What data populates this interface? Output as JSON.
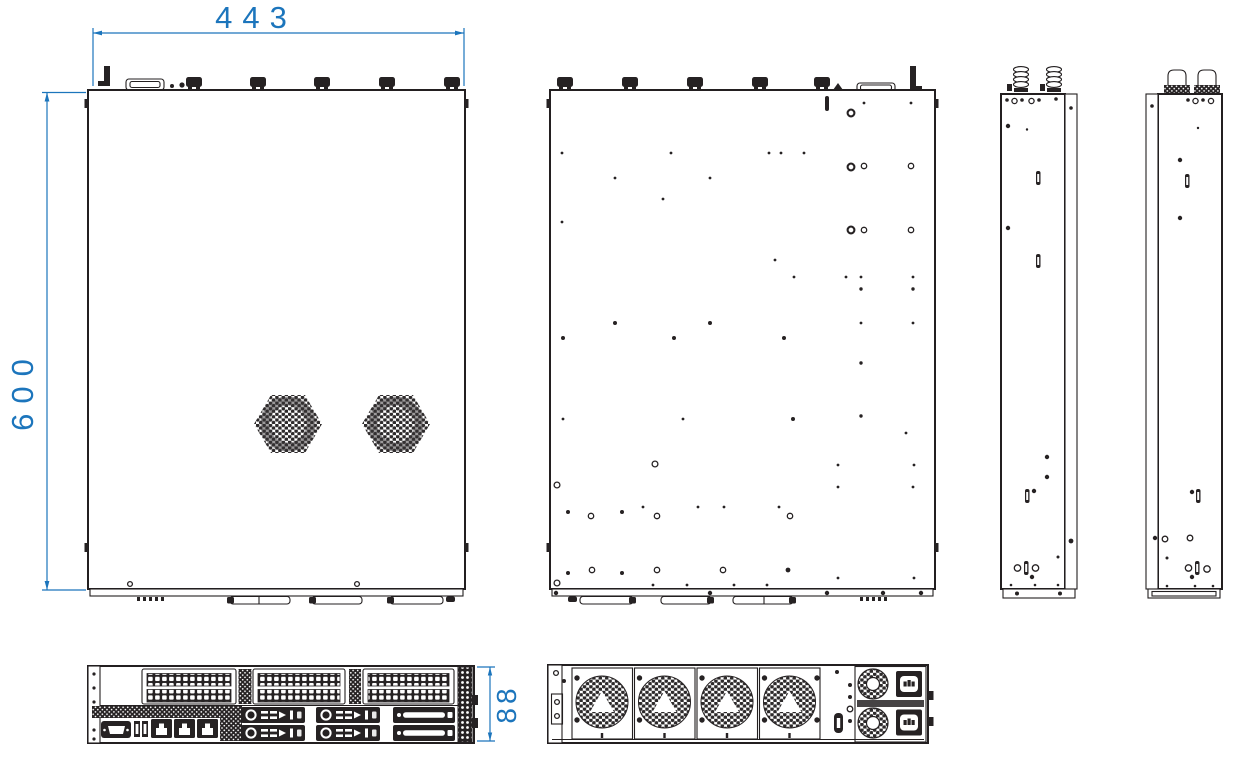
{
  "drawing": {
    "dimensions": {
      "width": "443",
      "depth": "600",
      "height": "88"
    }
  },
  "colors": {
    "dimension_blue": "#1C75BC",
    "line_black": "#231F20",
    "background": "#FFFFFF"
  }
}
